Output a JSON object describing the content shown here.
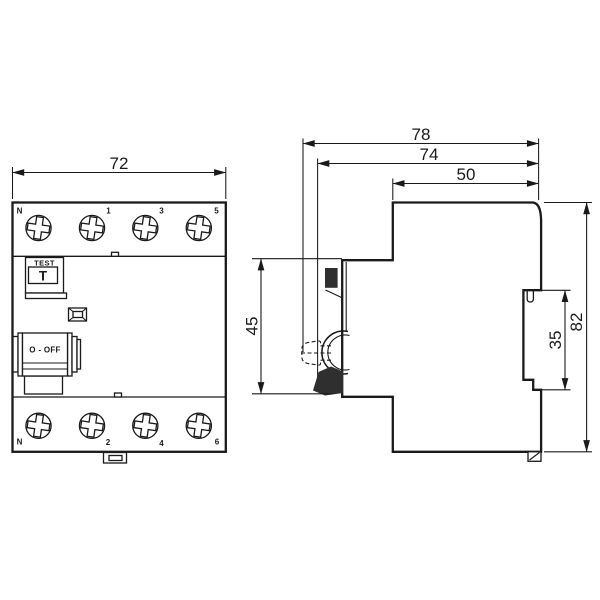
{
  "drawing": {
    "type": "dimensional technical drawing, 4-pole residual current device (front and side view)",
    "colors": {
      "line": "#1a1a1a",
      "background": "#ffffff",
      "dark_fill": "#2f2f2f"
    },
    "front_view": {
      "top_terminals": [
        "N",
        "1",
        "3",
        "5"
      ],
      "bottom_terminals": [
        "N",
        "2",
        "4",
        "6"
      ],
      "test_label": "TEST",
      "test_button": "T",
      "switch_label": "O - OFF"
    },
    "dimensions": {
      "width": "72",
      "depth_total": "78",
      "depth_body": "74",
      "depth_top": "50",
      "front_height": "45",
      "rail_slot": "35",
      "height": "82"
    }
  }
}
